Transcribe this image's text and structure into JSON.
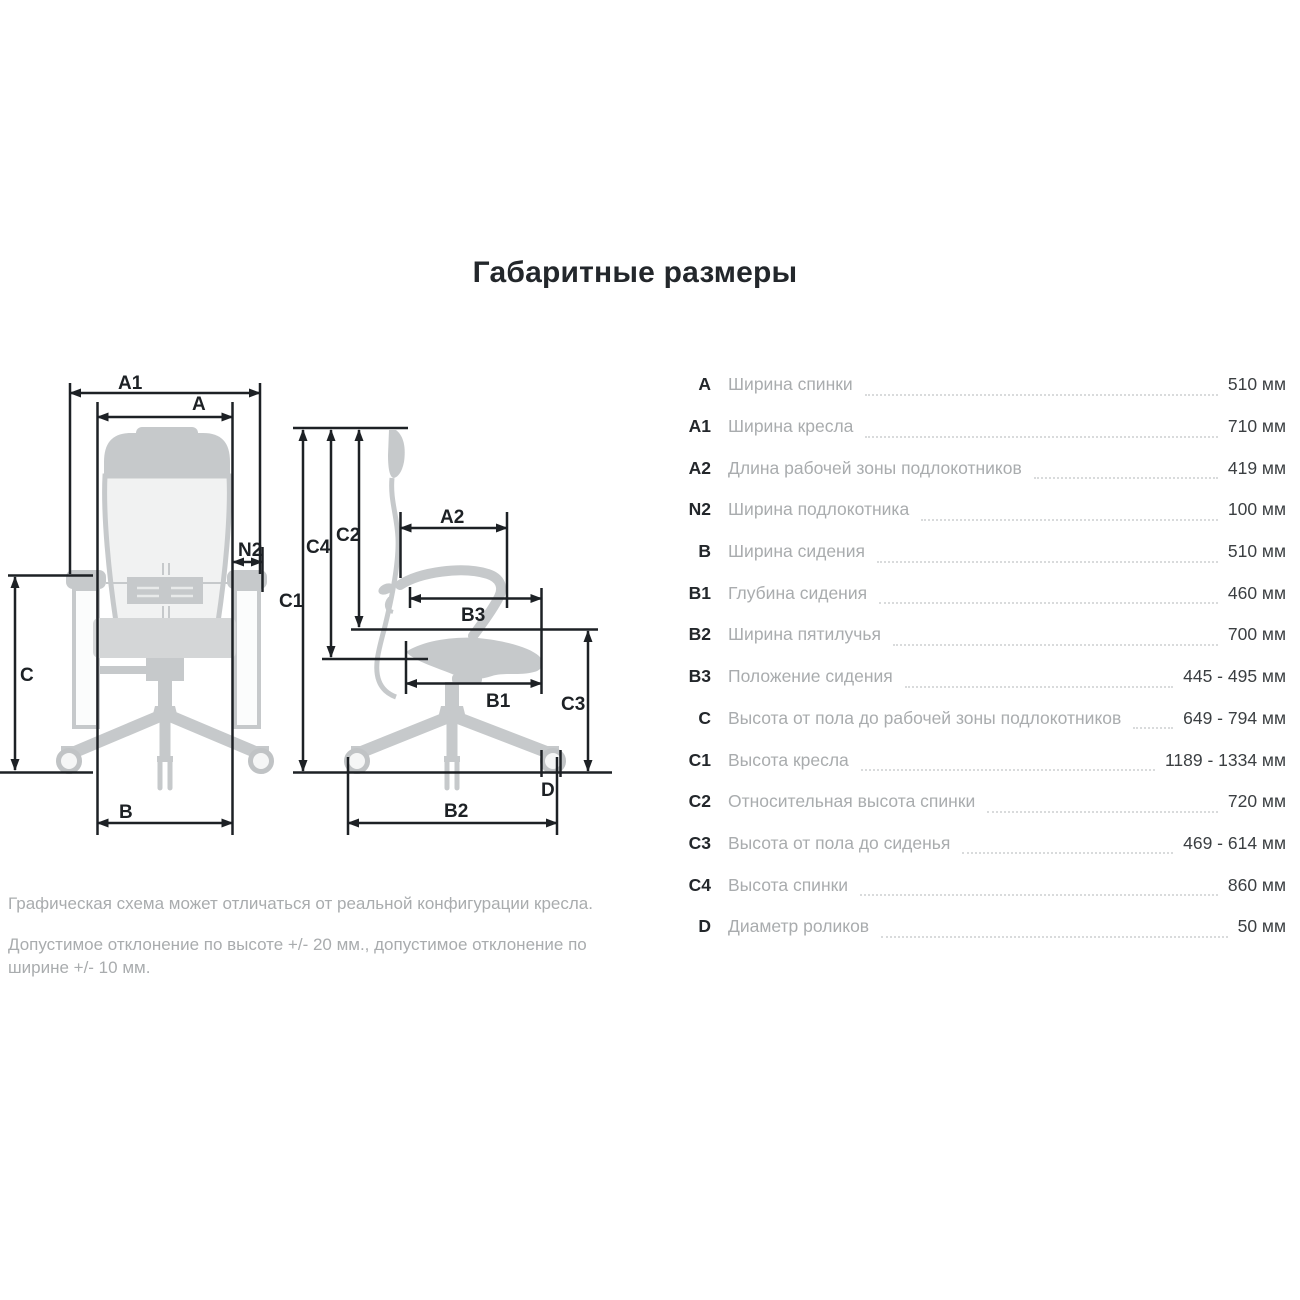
{
  "title": "Габаритные размеры",
  "table": {
    "rows": [
      {
        "code": "A",
        "label": "Ширина спинки",
        "value": "510 мм"
      },
      {
        "code": "A1",
        "label": "Ширина кресла",
        "value": "710 мм"
      },
      {
        "code": "A2",
        "label": "Длина рабочей зоны подлокотников",
        "value": "419 мм"
      },
      {
        "code": "N2",
        "label": "Ширина подлокотника",
        "value": "100 мм"
      },
      {
        "code": "B",
        "label": "Ширина сидения",
        "value": "510 мм"
      },
      {
        "code": "B1",
        "label": "Глубина сидения",
        "value": "460 мм"
      },
      {
        "code": "B2",
        "label": "Ширина пятилучья",
        "value": "700 мм"
      },
      {
        "code": "B3",
        "label": "Положение сидения",
        "value": "445 - 495 мм"
      },
      {
        "code": "C",
        "label": "Высота от пола до рабочей зоны подлокотников",
        "value": "649 - 794 мм"
      },
      {
        "code": "C1",
        "label": "Высота кресла",
        "value": "1189 - 1334 мм"
      },
      {
        "code": "C2",
        "label": "Относительная высота спинки",
        "value": "720 мм"
      },
      {
        "code": "C3",
        "label": "Высота от пола до сиденья",
        "value": "469 - 614 мм"
      },
      {
        "code": "C4",
        "label": "Высота спинки",
        "value": "860 мм"
      },
      {
        "code": "D",
        "label": "Диаметр роликов",
        "value": "50 мм"
      }
    ]
  },
  "diagram": {
    "labels": {
      "a1": "A1",
      "a": "A",
      "n2": "N2",
      "c": "C",
      "b": "B",
      "c4": "C4",
      "c2": "C2",
      "c1": "C1",
      "a2": "A2",
      "b3": "B3",
      "b1": "B1",
      "c3": "C3",
      "d": "D",
      "b2": "B2"
    }
  },
  "notes": {
    "line1": "Графическая схема может отличаться от реальной конфигурации кресла.",
    "line2": "Допустимое отклонение по высоте +/- 20 мм., допустимое отклонение по ширине +/- 10 мм."
  },
  "colors": {
    "dimension_line": "#1d2125",
    "chair_gray": "#c6c9cb",
    "chair_light": "#f1f2f2",
    "code_text": "#23272b",
    "label_text": "#a9acae",
    "value_text": "#3b3f42",
    "leader_dots": "#d9dbdc"
  }
}
